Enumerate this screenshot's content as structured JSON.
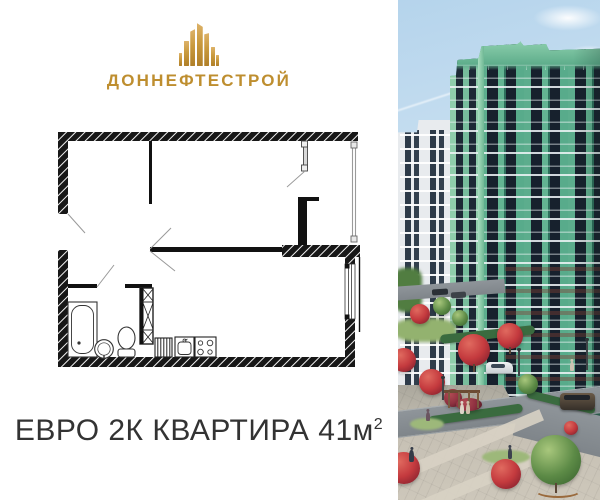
{
  "brand": {
    "name": "ДОННЕФТЕСТРОЙ",
    "color": "#BE8E2F",
    "logo_icon": "building-towers-icon"
  },
  "caption": {
    "text": "ЕВРО 2К КВАРТИРА 41м",
    "sup": "2",
    "color": "#333333"
  },
  "floor_plan": {
    "icons": [
      "bathtub-icon",
      "pedestal-sink-icon",
      "toilet-icon",
      "vent-shaft-icon",
      "radiator-icon",
      "kitchen-sink-icon",
      "stove-icon",
      "door-swing-icon",
      "window-icon",
      "balcony-door-icon",
      "glazing-icon"
    ]
  },
  "photo": {
    "colors": {
      "sky": "#BCD8EE",
      "building_green": "#5CAD8D",
      "building_green_light": "#8FCDAB",
      "building_white": "#E8EBEE",
      "window_dark": "#17212D",
      "tree_red": "#C43A3E",
      "tree_green": "#5C8A46",
      "road": "#878D92",
      "paving": "#C6C0B4"
    }
  }
}
